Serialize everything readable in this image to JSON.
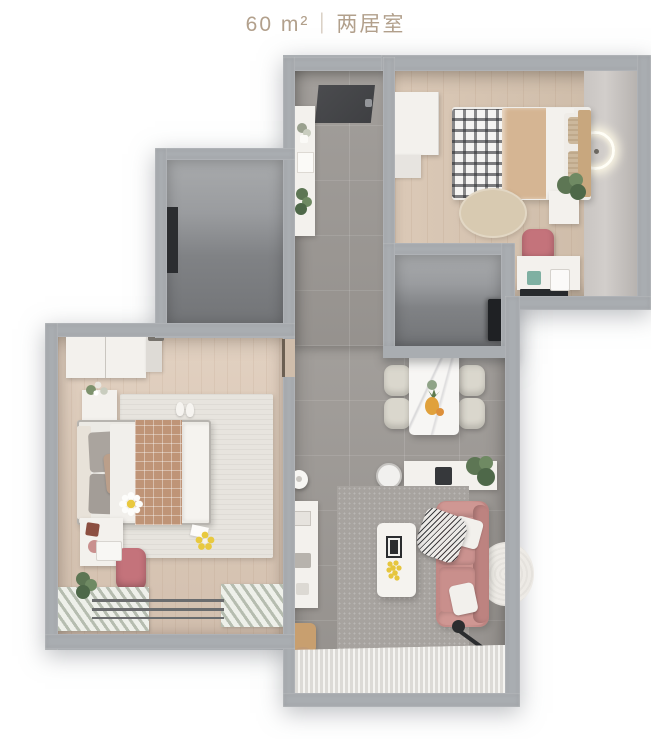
{
  "header": {
    "area": "60 m²",
    "divider": "｜",
    "layout_type": "两居室"
  },
  "palette": {
    "background": "#ffffff",
    "title_text": "#b2a08c",
    "wall": "#a9adb1",
    "tile_floor": "#9d9995",
    "wood_floor_master": "#dccaba",
    "wood_floor_second": "#d5c3b0",
    "dark_room": "#7a7c7f",
    "sofa_pink": "#c68d8a",
    "task_chair_pink": "#c4737b",
    "terracotta_blanket": "#bf9477",
    "light_rug": "#e7e4de",
    "sheer_curtain": "#eae8e4",
    "plant_green": "#5d7654",
    "accent_yellow": "#e8c93f"
  },
  "floorplan": {
    "rooms": [
      {
        "id": "entry-hall",
        "furniture": [
          "entry-mat",
          "storage-cabinet",
          "decor-plants"
        ]
      },
      {
        "id": "bedroom-second",
        "furniture": [
          "wardrobe",
          "single-bed",
          "plaid-blanket",
          "round-jute-rug",
          "nightstand",
          "plant",
          "desk",
          "task-chair",
          "tv-panel",
          "ring-wall-lamp"
        ]
      },
      {
        "id": "utility-room",
        "furniture": [
          "dark-wall-panel"
        ]
      },
      {
        "id": "bathroom",
        "furniture": [
          "dark-door"
        ]
      },
      {
        "id": "bedroom-master",
        "furniture": [
          "wardrobe",
          "double-bed",
          "daisy-pillow",
          "area-rug",
          "slippers",
          "nightstand",
          "desk",
          "task-chair",
          "window-curtains"
        ]
      },
      {
        "id": "dining-area",
        "furniture": [
          "marble-dining-table",
          "dining-chairs",
          "fruit-bowl",
          "robot-vacuum",
          "sideboard",
          "kettle"
        ]
      },
      {
        "id": "living-area",
        "furniture": [
          "pink-sofa",
          "white-pillows",
          "striped-throw",
          "coffee-table",
          "photo-frame",
          "media-console",
          "gray-rug",
          "round-nest-rug",
          "floor-lamp",
          "plants",
          "wooden-stool",
          "sheer-pleated-curtain"
        ]
      }
    ]
  }
}
